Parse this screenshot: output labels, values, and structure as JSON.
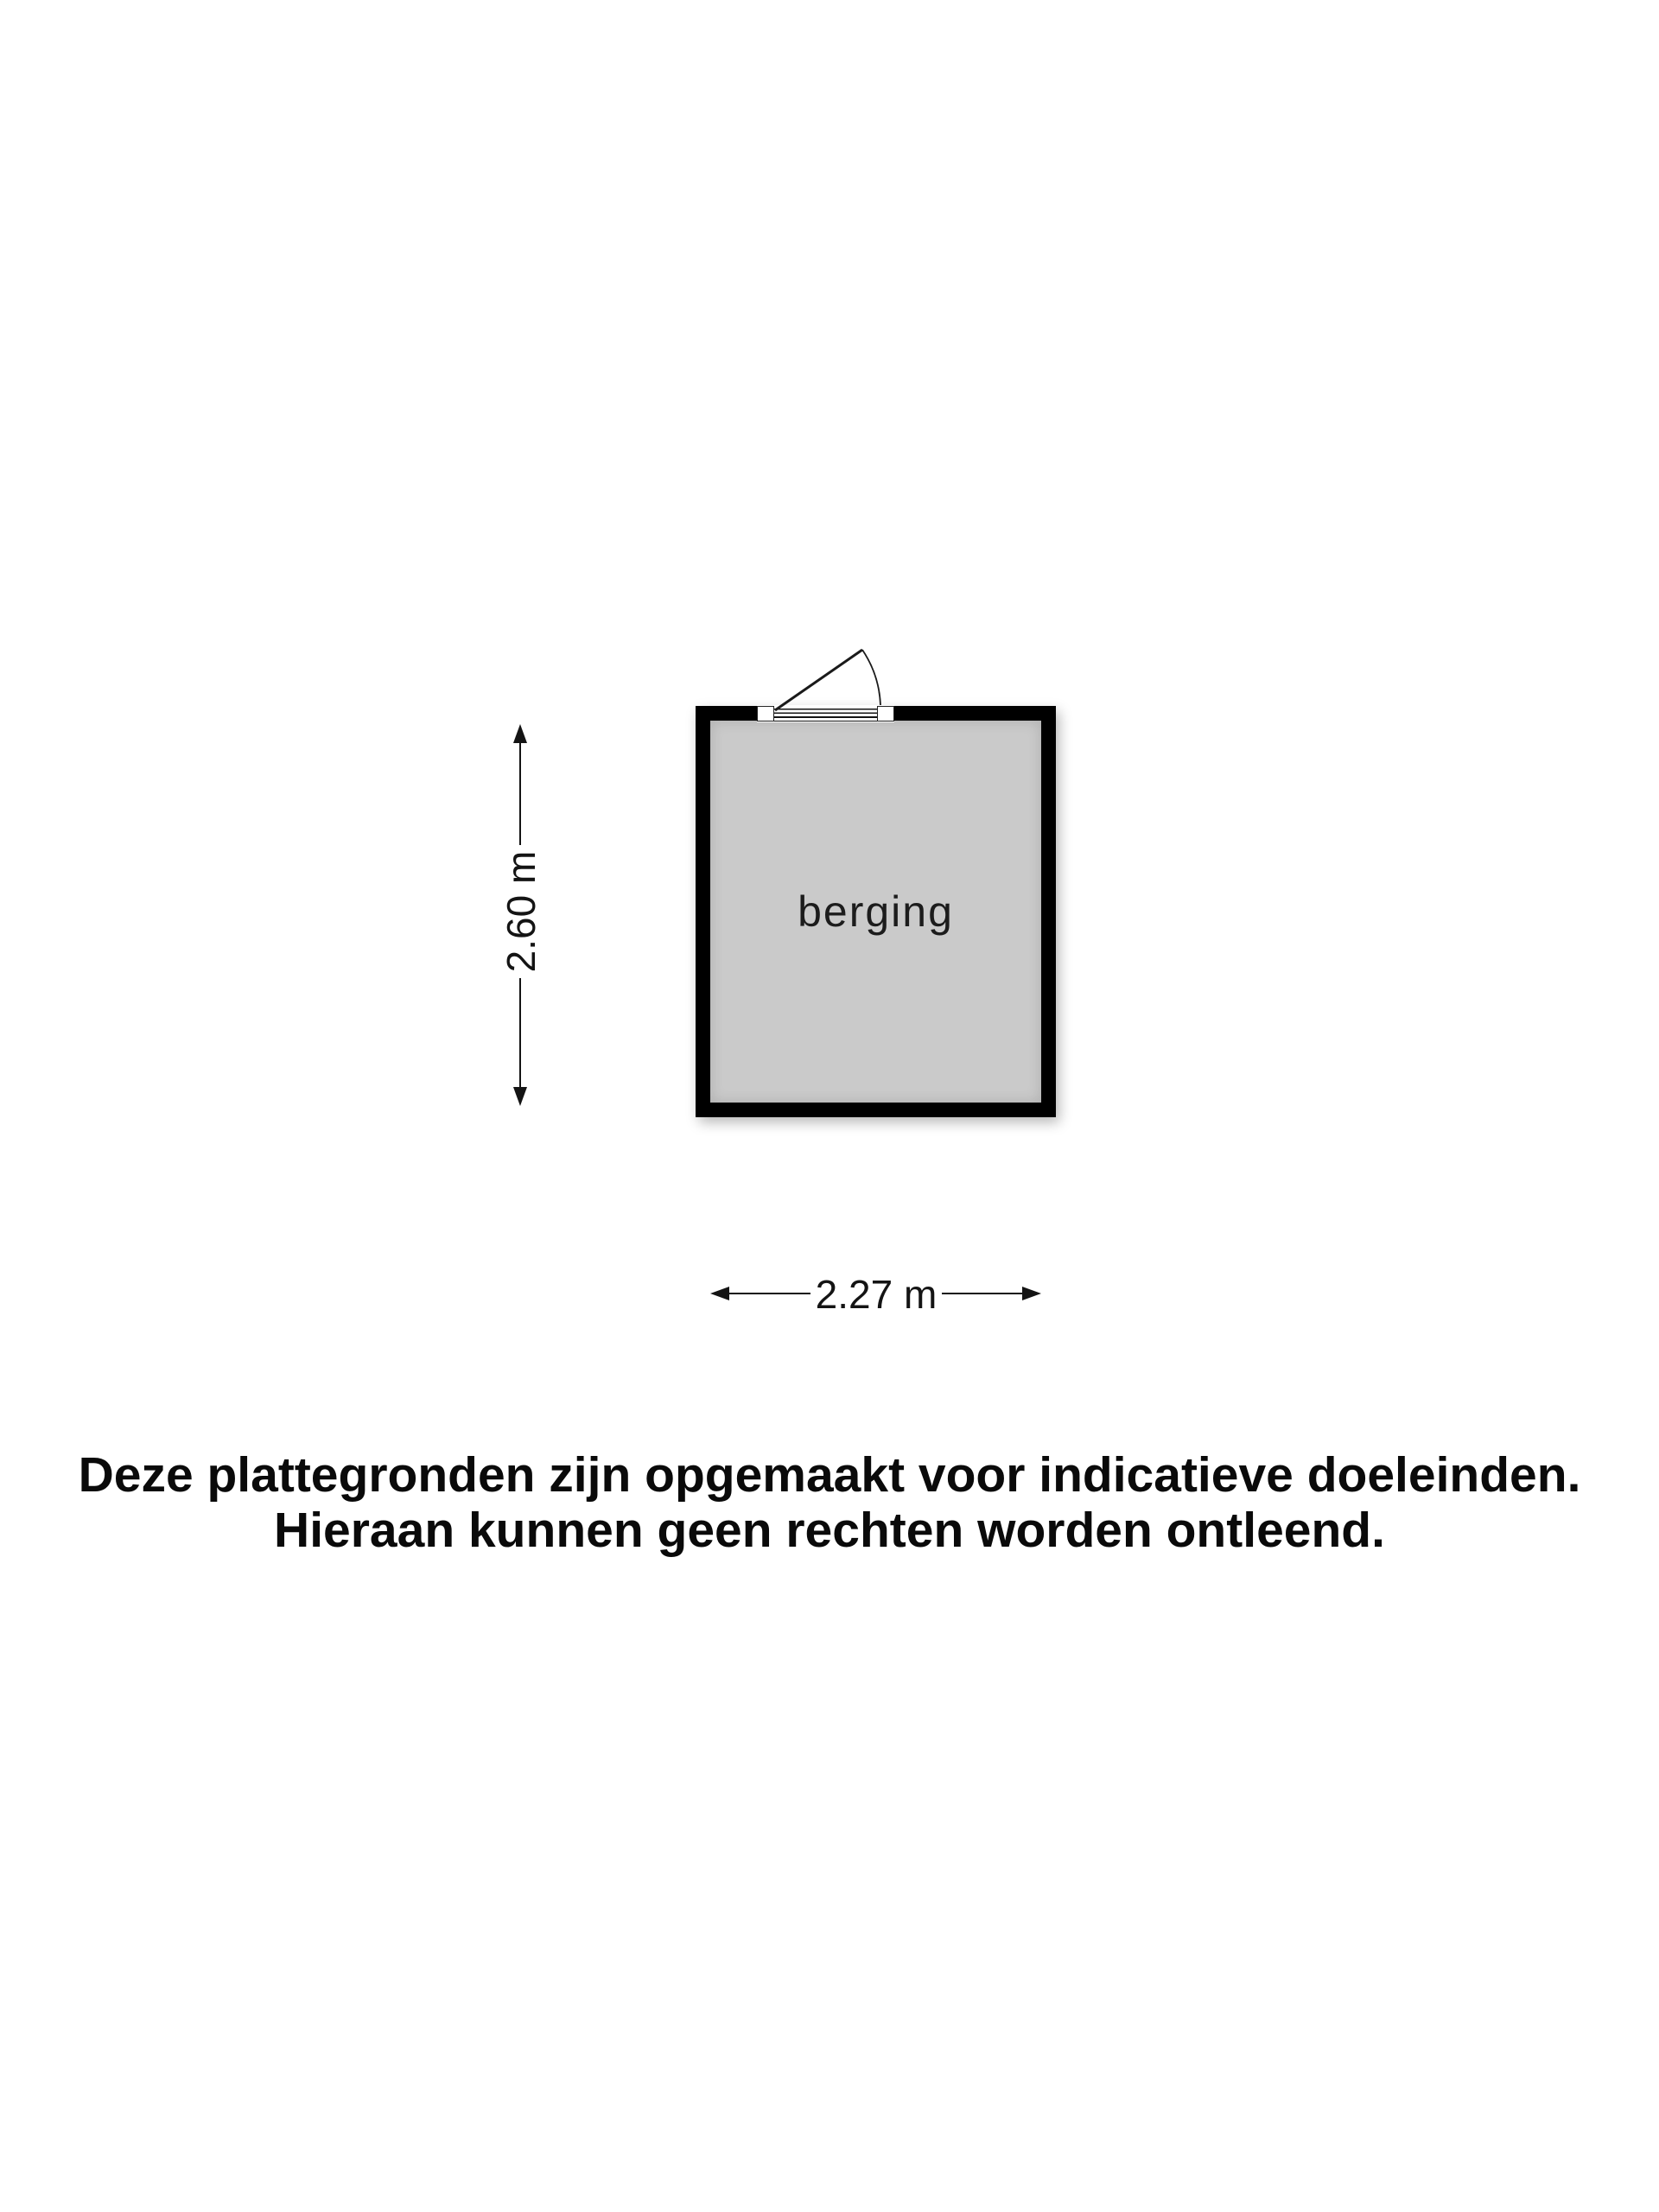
{
  "floorplan": {
    "room": {
      "label": "berging"
    },
    "dimensions": {
      "height_label": "2.60 m",
      "width_label": "2.27 m"
    },
    "colors": {
      "wall": "#000000",
      "floor": "#cacaca",
      "line": "#141414",
      "background": "#ffffff"
    }
  },
  "disclaimer": {
    "line1": "Deze plattegronden zijn opgemaakt voor indicatieve doeleinden.",
    "line2": "Hieraan kunnen geen rechten worden ontleend."
  }
}
